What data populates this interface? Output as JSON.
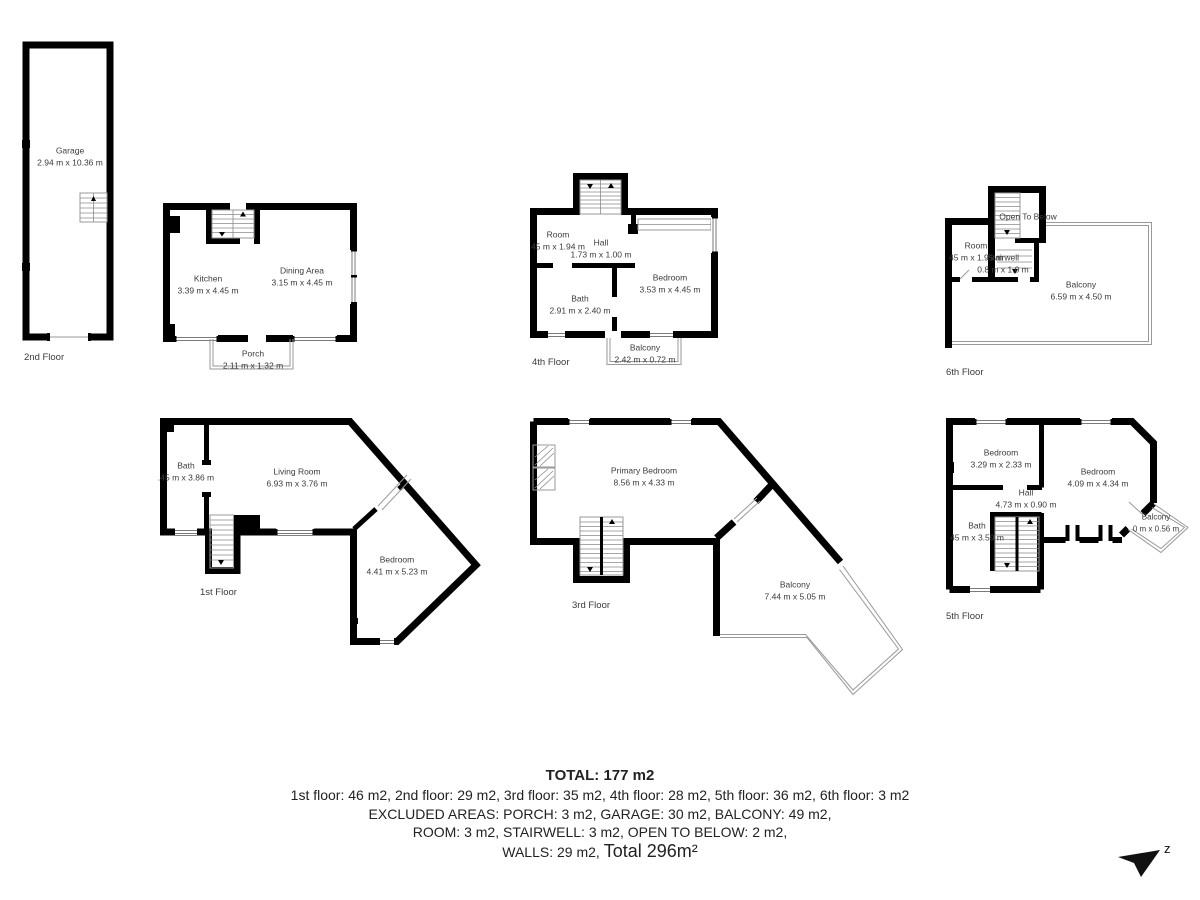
{
  "floor_labels": {
    "f1": "1st Floor",
    "f2": "2nd Floor",
    "f3": "3rd Floor",
    "f4": "4th Floor",
    "f5": "5th Floor",
    "f6": "6th Floor"
  },
  "rooms": {
    "garage": {
      "name": "Garage",
      "dims": "2.94 m x 10.36 m"
    },
    "kitchen": {
      "name": "Kitchen",
      "dims": "3.39 m x 4.45 m"
    },
    "dining": {
      "name": "Dining Area",
      "dims": "3.15 m x 4.45 m"
    },
    "porch": {
      "name": "Porch",
      "dims": "2.11 m x 1.32 m"
    },
    "f4_room": {
      "name": "Room",
      "dims": "45 m x 1.94 m"
    },
    "f4_hall": {
      "name": "Hall",
      "dims": "1.73 m x 1.00 m"
    },
    "f4_bath": {
      "name": "Bath",
      "dims": "2.91 m x 2.40 m"
    },
    "f4_bedroom": {
      "name": "Bedroom",
      "dims": "3.53 m x 4.45 m"
    },
    "f4_balcony": {
      "name": "Balcony",
      "dims": "2.42 m x 0.72 m"
    },
    "f6_open": {
      "name": "Open To Below"
    },
    "f6_room": {
      "name": "Room",
      "dims": "45 m x 1.95 m"
    },
    "f6_stairwell": {
      "name": "Stairwell",
      "dims": "0.8 m x 1.0 m"
    },
    "f6_balcony": {
      "name": "Balcony",
      "dims": "6.59 m x 4.50 m"
    },
    "f1_bath": {
      "name": "Bath",
      "dims": ".45 m x 3.86 m"
    },
    "f1_living": {
      "name": "Living Room",
      "dims": "6.93 m x 3.76 m"
    },
    "f1_bedroom": {
      "name": "Bedroom",
      "dims": "4.41 m x 5.23 m"
    },
    "f3_primary": {
      "name": "Primary Bedroom",
      "dims": "8.56 m x 4.33 m"
    },
    "f3_balcony": {
      "name": "Balcony",
      "dims": "7.44 m x 5.05 m"
    },
    "f5_bedroom1": {
      "name": "Bedroom",
      "dims": "3.29 m x 2.33 m"
    },
    "f5_bedroom2": {
      "name": "Bedroom",
      "dims": "4.09 m x 4.34 m"
    },
    "f5_hall": {
      "name": "Hall",
      "dims": "4.73 m x 0.90 m"
    },
    "f5_bath": {
      "name": "Bath",
      "dims": "45 m x 3.59 m"
    },
    "f5_balcony": {
      "name": "Balcony",
      "dims": "0 m x 0.56 m"
    }
  },
  "summary": {
    "total": "TOTAL: 177 m2",
    "floors_line": "1st floor: 46 m2, 2nd floor: 29 m2, 3rd floor: 35 m2, 4th floor: 28 m2, 5th floor: 36 m2, 6th floor: 3 m2",
    "excluded_line1": "EXCLUDED AREAS: PORCH: 3 m2, GARAGE: 30 m2, BALCONY: 49 m2,",
    "excluded_line2": "ROOM: 3 m2, STAIRWELL: 3 m2, OPEN TO BELOW: 2 m2,",
    "walls_prefix": "WALLS: 29 m2, ",
    "grand_total": "Total 296m²"
  },
  "compass": {
    "letter": "z"
  },
  "colors": {
    "wall": "#000000",
    "thin_line": "#999999",
    "label_text": "#3b3b3b"
  }
}
